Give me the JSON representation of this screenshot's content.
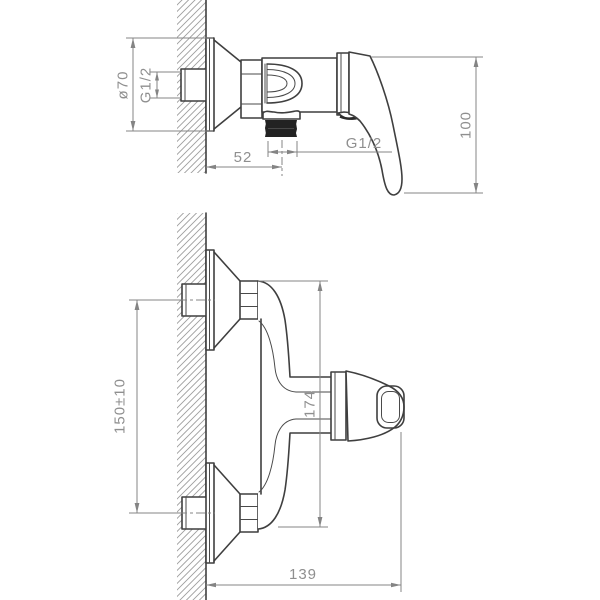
{
  "drawing": {
    "subject": "Wall-mounted single-lever shower mixer installation drawing, two projection views",
    "colors": {
      "outline": "#3f3f3f",
      "dimension_lines": "#848484",
      "labels": "#8f8f8f",
      "wall_hatch": "#9e9e9e",
      "thread_fill": "#222222",
      "background": "#ffffff"
    },
    "side_view": {
      "labels": {
        "escutcheon_diameter": "ø70",
        "inlet_thread": "G1/2",
        "outlet_thread": "G1/2",
        "wall_to_outlet_mm": "52",
        "handle_drop_mm": "100"
      }
    },
    "front_view": {
      "labels": {
        "inlet_spacing_mm": "150±10",
        "body_height_mm": "174",
        "wall_to_handle_mm": "139"
      }
    }
  }
}
